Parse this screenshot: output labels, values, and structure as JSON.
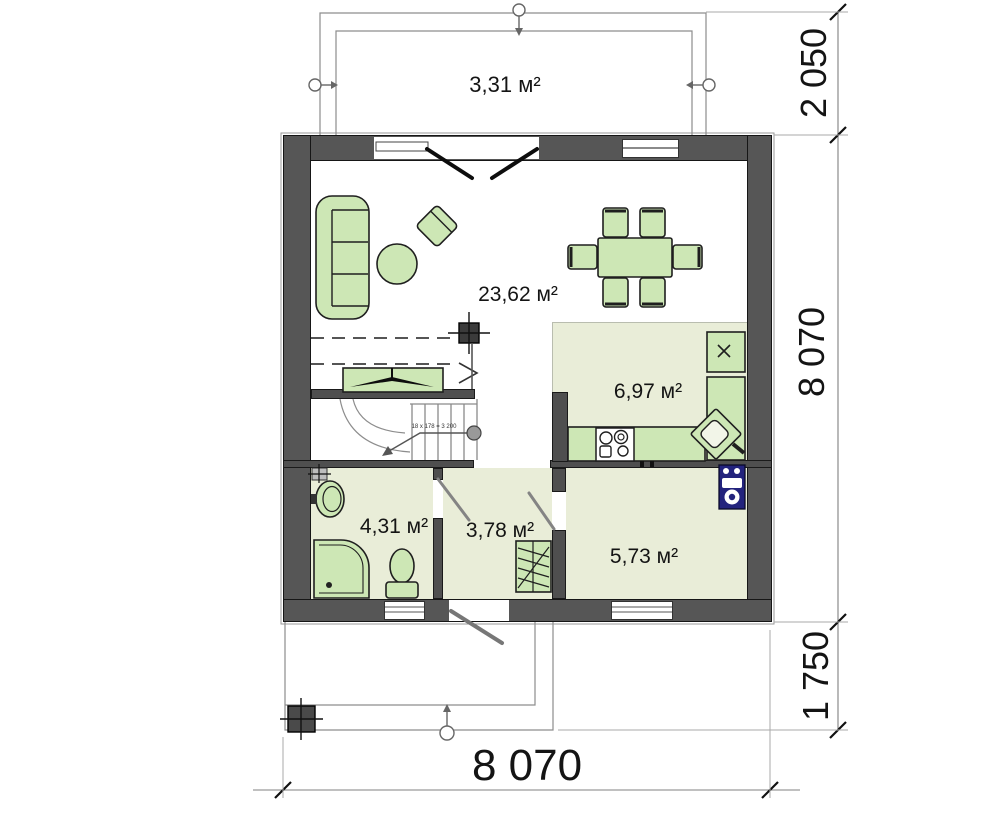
{
  "plan": {
    "rooms": [
      {
        "id": "terrace",
        "area": "3,31 м²"
      },
      {
        "id": "living",
        "area": "23,62 м²"
      },
      {
        "id": "kitchen",
        "area": "6,97 м²"
      },
      {
        "id": "bathroom",
        "area": "4,31 м²"
      },
      {
        "id": "hall",
        "area": "3,78 м²"
      },
      {
        "id": "room",
        "area": "5,73 м²"
      }
    ],
    "stairs_note": "18 x 178 = 3 200",
    "dimensions": {
      "top_right": "2 050",
      "right": "8 070",
      "bottom_right": "1 750",
      "bottom": "8 070"
    },
    "colors": {
      "wall": "#565656",
      "wallline": "#161616",
      "furniture": "#cde7b5",
      "floor": "#e9edd8",
      "appliance": "#23237d",
      "line": "#8d8d8d"
    }
  }
}
